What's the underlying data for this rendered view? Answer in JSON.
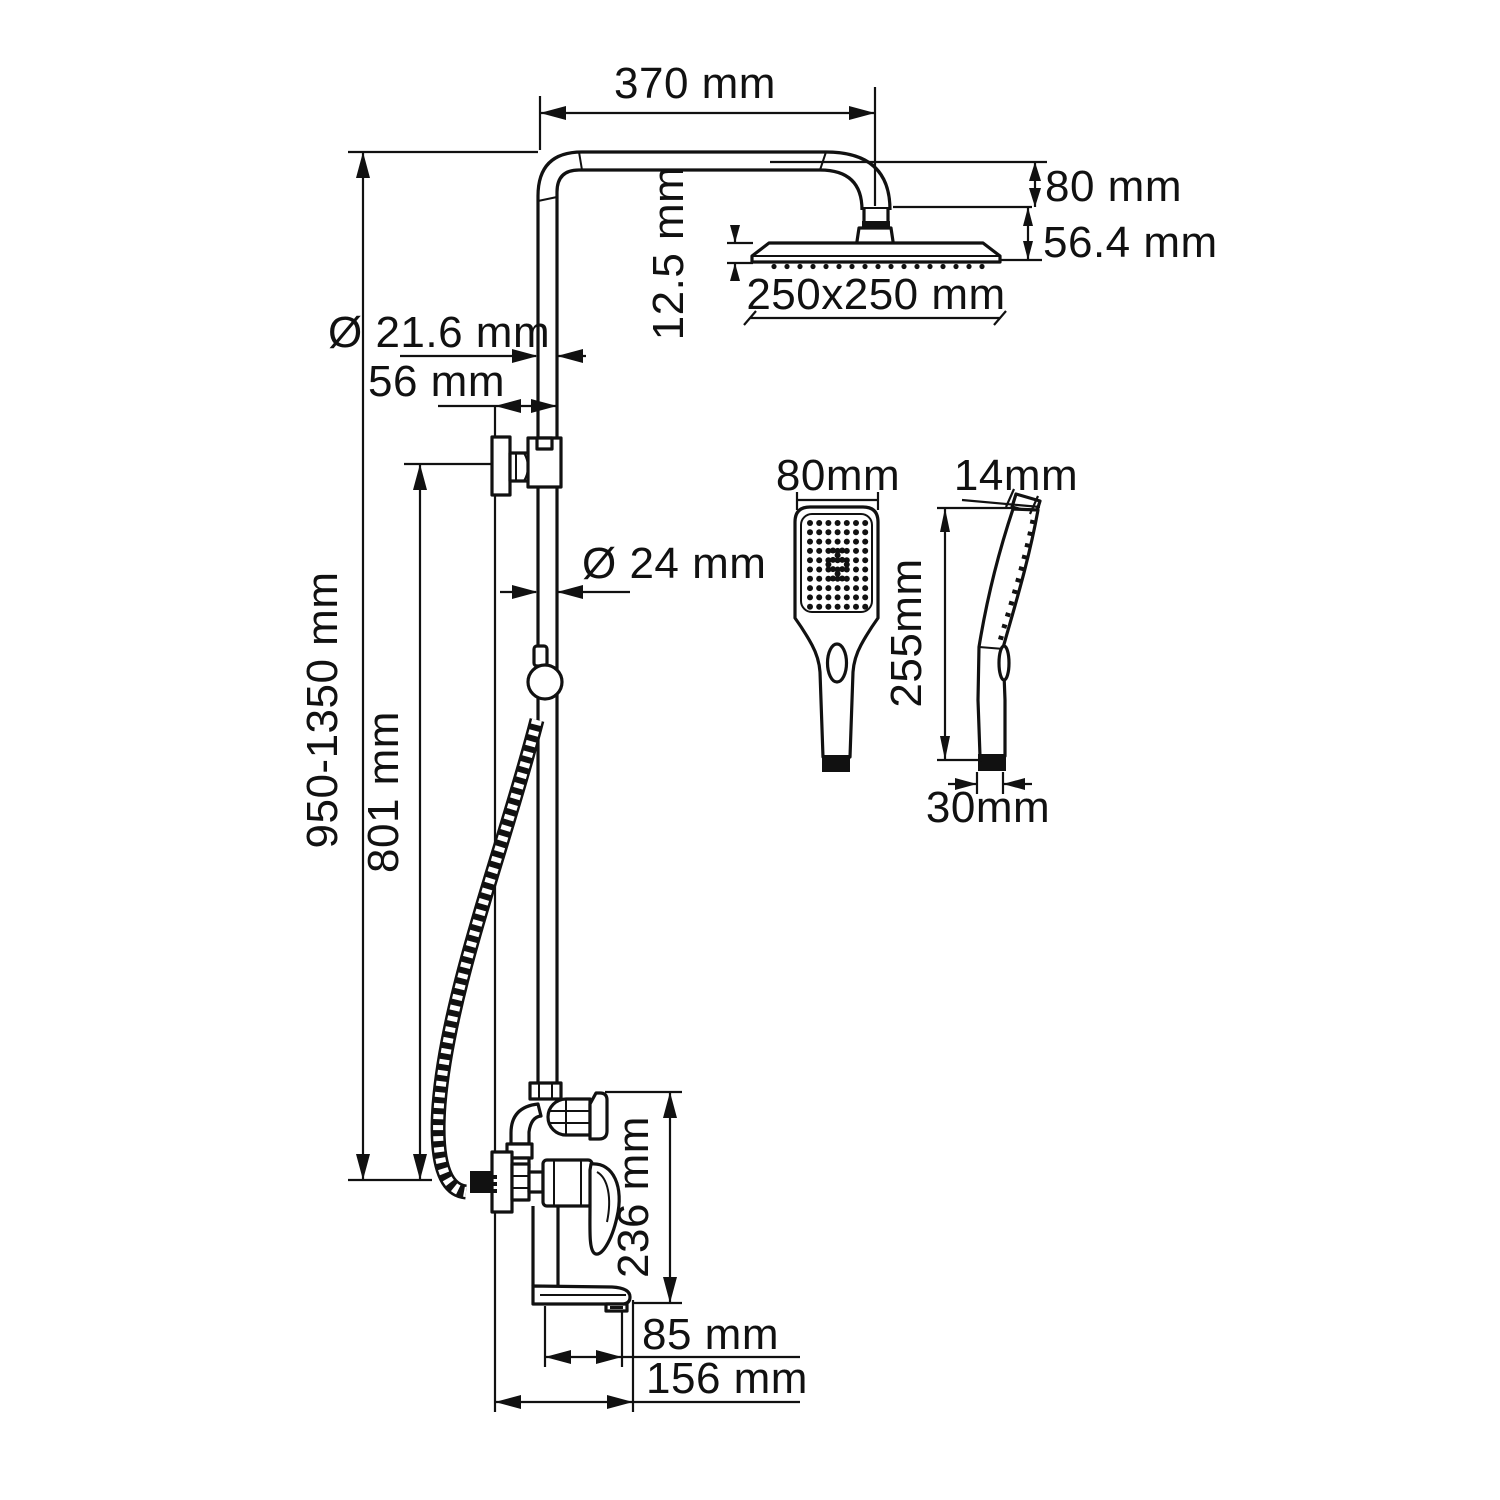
{
  "drawing": {
    "type": "shower-system-technical-drawing",
    "line_color": "#111111",
    "background_color": "#ffffff"
  },
  "dimensions": {
    "arm_length": "370 mm",
    "head_offset_height": "80 mm",
    "head_total_height": "56.4 mm",
    "head_thickness": "12.5 mm",
    "head_size": "250x250 mm",
    "top_pipe_diameter": "Ø 21.6 mm",
    "wall_offset": "56 mm",
    "pipe_diameter": "Ø 24 mm",
    "column_height_range": "950-1350 mm",
    "bracket_distance": "801 mm",
    "mixer_height": "236 mm",
    "spout_reach": "85 mm",
    "total_depth": "156 mm"
  },
  "handshower": {
    "width": "80mm",
    "depth": "14mm",
    "length": "255mm",
    "handle_width": "30mm"
  }
}
